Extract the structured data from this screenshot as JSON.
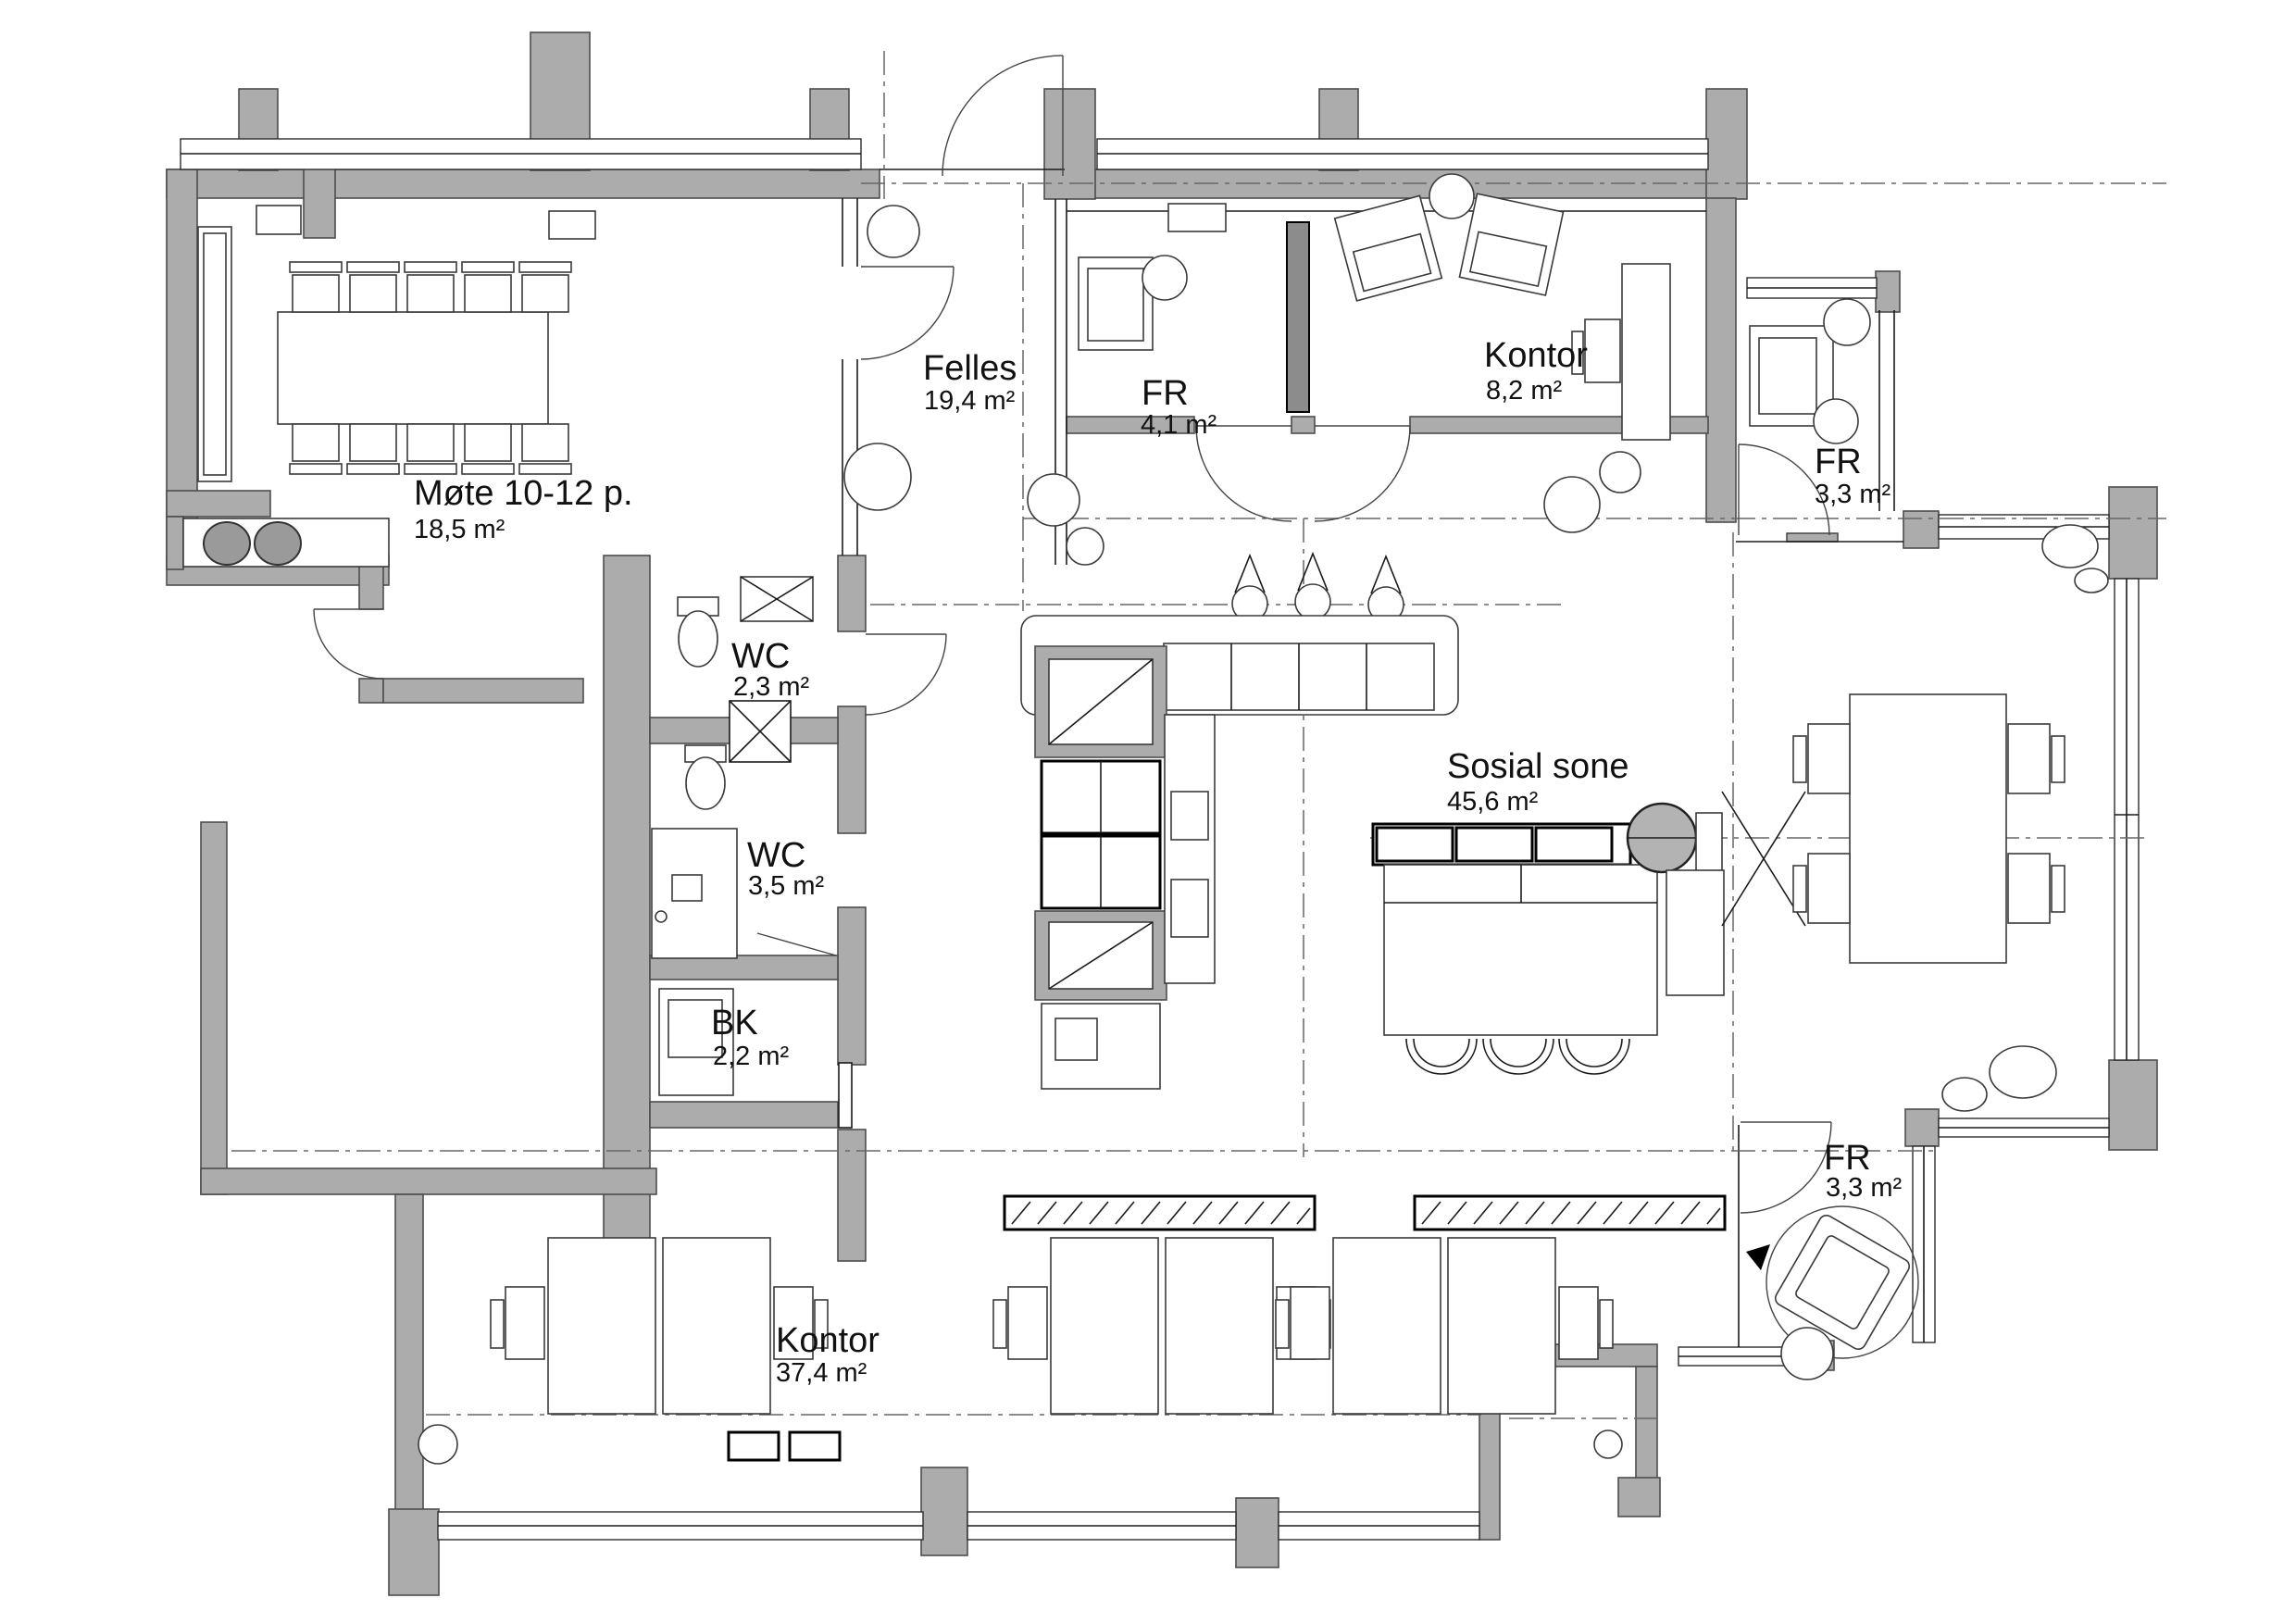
{
  "drawing": {
    "type": "architectural floor plan",
    "colors": {
      "wall": "#acacac",
      "wall_stroke": "#4d4d4d",
      "line": "#1a1a1a",
      "reference_line": "#666666",
      "dark_partition": "#8c8c8c",
      "fixture_gray": "#b3b3b3",
      "background": "#ffffff"
    }
  },
  "rooms": [
    {
      "name": "Møte 10-12 p.",
      "area": "18,5 m²"
    },
    {
      "name": "Felles",
      "area": "19,4 m²"
    },
    {
      "name": "FR",
      "area": "4,1 m²"
    },
    {
      "name": "Kontor",
      "area": "8,2 m²"
    },
    {
      "name": "FR",
      "area": "3,3 m²"
    },
    {
      "name": "WC",
      "area": "2,3 m²"
    },
    {
      "name": "WC",
      "area": "3,5 m²"
    },
    {
      "name": "BK",
      "area": "2,2 m²"
    },
    {
      "name": "Sosial sone",
      "area": "45,6 m²"
    },
    {
      "name": "Kontor",
      "area": "37,4 m²"
    },
    {
      "name": "FR",
      "area": "3,3 m²"
    }
  ]
}
